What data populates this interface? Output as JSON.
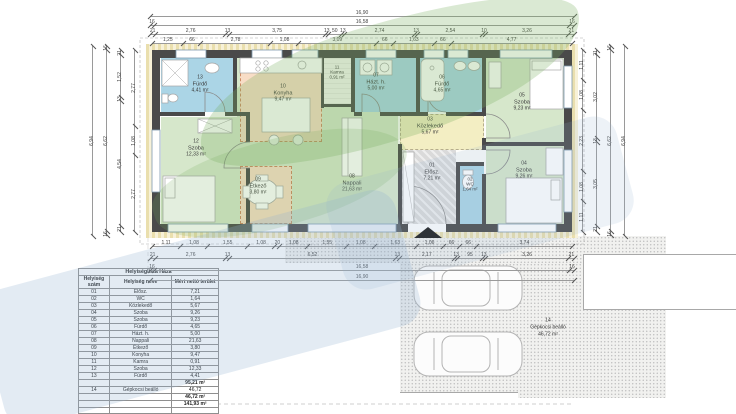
{
  "palette": {
    "green": "#d6e7cb",
    "blue": "#abd5e6",
    "peach": "#f8ddc6",
    "yellow": "#f3eec3",
    "gray": "#dadada",
    "insulation": "#eadfae",
    "stipple_bg": "#f1f1ef",
    "accent_dash": "#cd8a63",
    "wm_green": "rgba(118,172,92,0.27)",
    "wm_blue": "rgba(148,176,208,0.26)"
  },
  "plan": {
    "rooms": [
      {
        "num": "08",
        "name": "Nappali",
        "area": "21,63 m²",
        "x": 237,
        "y": 58,
        "w": 161,
        "h": 166,
        "fill": "green",
        "lx": 352,
        "ly": 183
      },
      {
        "num": "12",
        "name": "Szoba",
        "area": "12,33 m²",
        "x": 161,
        "y": 117,
        "w": 85,
        "h": 107,
        "fill": "green",
        "lx": 196,
        "ly": 148
      },
      {
        "num": "13",
        "name": "Fürdő",
        "area": "4,41 m²",
        "x": 161,
        "y": 58,
        "w": 72,
        "h": 54,
        "fill": "blue",
        "lx": 200,
        "ly": 84
      },
      {
        "num": "10",
        "name": "Konyha",
        "area": "9,47 m²",
        "x": 240,
        "y": 58,
        "w": 82,
        "h": 84,
        "fill": "peach",
        "dashed": true,
        "lx": 283,
        "ly": 93
      },
      {
        "num": "11",
        "name": "Kamra",
        "area": "0,91 m²",
        "x": 324,
        "y": 58,
        "w": 27,
        "h": 46,
        "fill": "white",
        "lx": 337,
        "ly": 72,
        "small": true
      },
      {
        "num": "07",
        "name": "Házt. h.",
        "area": "5,00 m²",
        "x": 355,
        "y": 58,
        "w": 61,
        "h": 54,
        "fill": "blue",
        "lx": 376,
        "ly": 82
      },
      {
        "num": "06",
        "name": "Fürdő",
        "area": "4,65 m²",
        "x": 420,
        "y": 58,
        "w": 62,
        "h": 54,
        "fill": "blue",
        "lx": 442,
        "ly": 84
      },
      {
        "num": "05",
        "name": "Szoba",
        "area": "9,23 m²",
        "x": 486,
        "y": 58,
        "w": 78,
        "h": 84,
        "fill": "green",
        "lx": 522,
        "ly": 102
      },
      {
        "num": "04",
        "name": "Szoba",
        "area": "9,26 m²",
        "x": 486,
        "y": 146,
        "w": 78,
        "h": 78,
        "fill": "green",
        "lx": 524,
        "ly": 170
      },
      {
        "num": "03",
        "name": "Közlekedő",
        "area": "5,67 m²",
        "x": 400,
        "y": 114,
        "w": 84,
        "h": 36,
        "fill": "yellow",
        "dashed2": true,
        "lx": 430,
        "ly": 126
      },
      {
        "num": "01",
        "name": "Elősz.",
        "area": "7,21 m²",
        "x": 402,
        "y": 150,
        "w": 54,
        "h": 74,
        "fill": "gray",
        "lx": 432,
        "ly": 172
      },
      {
        "num": "02",
        "name": "WC",
        "area": "1,64 m²",
        "x": 458,
        "y": 166,
        "w": 26,
        "h": 58,
        "fill": "blue",
        "lx": 470,
        "ly": 184,
        "small": true
      },
      {
        "num": "09",
        "name": "Étkező",
        "area": "3,80 m²",
        "x": 240,
        "y": 166,
        "w": 52,
        "h": 58,
        "fill": "peach",
        "dashed": true,
        "lx": 258,
        "ly": 186
      }
    ],
    "parking": {
      "num": "14",
      "name": "Gépkocsi beálló",
      "area": "46,72 m²"
    }
  },
  "dimensions": {
    "top": [
      {
        "x": 150,
        "y": 10,
        "len": 424,
        "segs": [
          {
            "t": "16,90",
            "f": 16.9
          }
        ]
      },
      {
        "x": 150,
        "y": 19,
        "len": 424,
        "segs": [
          {
            "t": "16",
            "f": 0.16
          },
          {
            "t": "16,58",
            "f": 16.58
          },
          {
            "t": "16",
            "f": 0.16
          }
        ]
      },
      {
        "x": 150,
        "y": 28,
        "len": 424,
        "segs": [
          {
            "t": "21",
            "f": 0.21
          },
          {
            "t": "2,76",
            "f": 2.76
          },
          {
            "t": "13",
            "f": 0.13
          },
          {
            "t": "3,75",
            "f": 3.75
          },
          {
            "t": "13",
            "f": 0.13
          },
          {
            "t": "50",
            "f": 0.5
          },
          {
            "t": "13",
            "f": 0.13
          },
          {
            "t": "2,74",
            "f": 2.74
          },
          {
            "t": "13",
            "f": 0.13
          },
          {
            "t": "2,54",
            "f": 2.54
          },
          {
            "t": "10",
            "f": 0.1
          },
          {
            "t": "3,26",
            "f": 3.26
          },
          {
            "t": "21",
            "f": 0.21
          }
        ]
      },
      {
        "x": 152,
        "y": 37,
        "len": 420,
        "segs": [
          {
            "t": "1,25",
            "f": 1.25
          },
          {
            "t": "66",
            "f": 0.66
          },
          {
            "t": "2,78",
            "f": 2.78
          },
          {
            "t": "1,08",
            "f": 1.08
          },
          {
            "t": "3,09",
            "f": 3.09
          },
          {
            "t": "66",
            "f": 0.66
          },
          {
            "t": "1,63",
            "f": 1.63
          },
          {
            "t": "66",
            "f": 0.66
          },
          {
            "t": "4,77",
            "f": 4.77
          }
        ]
      }
    ],
    "bottom": [
      {
        "x": 152,
        "y": 240,
        "len": 420,
        "segs": [
          {
            "t": "1,11",
            "f": 1.11
          },
          {
            "t": "1,08",
            "f": 1.08
          },
          {
            "t": "1,55",
            "f": 1.55
          },
          {
            "t": "1,08",
            "f": 1.08
          },
          {
            "t": "20",
            "f": 0.2
          },
          {
            "t": "1,08",
            "f": 1.08
          },
          {
            "t": "1,55",
            "f": 1.55
          },
          {
            "t": "1,08",
            "f": 1.08
          },
          {
            "t": "1,63",
            "f": 1.63
          },
          {
            "t": "1,06",
            "f": 1.06
          },
          {
            "t": "66",
            "f": 0.66
          },
          {
            "t": "66",
            "f": 0.66
          },
          {
            "t": "3,74",
            "f": 3.74
          }
        ]
      },
      {
        "x": 150,
        "y": 252,
        "len": 424,
        "segs": [
          {
            "t": "21",
            "f": 0.21
          },
          {
            "t": "2,76",
            "f": 2.76
          },
          {
            "t": "13",
            "f": 0.13
          },
          {
            "t": "6,52",
            "f": 6.52
          },
          {
            "t": "13",
            "f": 0.13
          },
          {
            "t": "2,17",
            "f": 2.17
          },
          {
            "t": "13",
            "f": 0.13
          },
          {
            "t": "95",
            "f": 0.95
          },
          {
            "t": "13",
            "f": 0.13
          },
          {
            "t": "3,26",
            "f": 3.26
          },
          {
            "t": "21",
            "f": 0.21
          }
        ]
      },
      {
        "x": 150,
        "y": 264,
        "len": 424,
        "segs": [
          {
            "t": "16",
            "f": 0.16
          },
          {
            "t": "16,58",
            "f": 16.58
          },
          {
            "t": "16",
            "f": 0.16
          }
        ]
      },
      {
        "x": 150,
        "y": 274,
        "len": 424,
        "segs": [
          {
            "t": "16,90",
            "f": 16.9
          }
        ]
      }
    ],
    "left": [
      {
        "x": 134,
        "y": 50,
        "len": 182,
        "segs": [
          {
            "t": "2,77",
            "f": 2.77
          },
          {
            "t": "1,08",
            "f": 1.08
          },
          {
            "t": "2,77",
            "f": 2.77
          }
        ]
      },
      {
        "x": 120,
        "y": 50,
        "len": 182,
        "segs": [
          {
            "t": "21",
            "f": 0.21
          },
          {
            "t": "1,52",
            "f": 1.52
          },
          {
            "t": "13",
            "f": 0.13
          },
          {
            "t": "4,54",
            "f": 4.54
          },
          {
            "t": "21",
            "f": 0.21
          }
        ]
      },
      {
        "x": 106,
        "y": 46,
        "len": 190,
        "segs": [
          {
            "t": "16",
            "f": 0.16
          },
          {
            "t": "6,62",
            "f": 6.62
          },
          {
            "t": "16",
            "f": 0.16
          }
        ]
      },
      {
        "x": 92,
        "y": 46,
        "len": 190,
        "segs": [
          {
            "t": "6,94",
            "f": 6.94
          }
        ]
      }
    ],
    "right": [
      {
        "x": 582,
        "y": 50,
        "len": 182,
        "segs": [
          {
            "t": "1,11",
            "f": 1.11
          },
          {
            "t": "1,08",
            "f": 1.08
          },
          {
            "t": "2,23",
            "f": 2.23
          },
          {
            "t": "1,08",
            "f": 1.08
          },
          {
            "t": "1,11",
            "f": 1.11
          }
        ]
      },
      {
        "x": 596,
        "y": 50,
        "len": 182,
        "segs": [
          {
            "t": "21",
            "f": 0.21
          },
          {
            "t": "3,02",
            "f": 3.02
          },
          {
            "t": "13",
            "f": 0.13
          },
          {
            "t": "3,05",
            "f": 3.05
          },
          {
            "t": "21",
            "f": 0.21
          }
        ]
      },
      {
        "x": 610,
        "y": 46,
        "len": 190,
        "segs": [
          {
            "t": "16",
            "f": 0.16
          },
          {
            "t": "6,62",
            "f": 6.62
          },
          {
            "t": "16",
            "f": 0.16
          }
        ]
      },
      {
        "x": 624,
        "y": 46,
        "len": 190,
        "segs": [
          {
            "t": "6,94",
            "f": 6.94
          }
        ]
      }
    ]
  },
  "table": {
    "title": "Helyiséglista Háza",
    "headers": [
      "Helyiség szám",
      "Helyiség neve",
      "Mért nettó terület"
    ],
    "rows": [
      {
        "c": [
          "01",
          "Elősz.",
          "7,21"
        ]
      },
      {
        "c": [
          "02",
          "WC",
          "1,64"
        ]
      },
      {
        "c": [
          "03",
          "Közlekedő",
          "5,67"
        ]
      },
      {
        "c": [
          "04",
          "Szoba",
          "9,26"
        ]
      },
      {
        "c": [
          "05",
          "Szoba",
          "9,23"
        ]
      },
      {
        "c": [
          "06",
          "Fürdő",
          "4,65"
        ]
      },
      {
        "c": [
          "07",
          "Házt. h.",
          "5,00"
        ]
      },
      {
        "c": [
          "08",
          "Nappali",
          "21,63"
        ]
      },
      {
        "c": [
          "09",
          "Étkező",
          "3,80"
        ]
      },
      {
        "c": [
          "10",
          "Konyha",
          "9,47"
        ]
      },
      {
        "c": [
          "11",
          "Kamra",
          "0,91"
        ]
      },
      {
        "c": [
          "12",
          "Szoba",
          "12,33"
        ]
      },
      {
        "c": [
          "13",
          "Fürdő",
          "4,41"
        ]
      },
      {
        "c": [
          "",
          "",
          "95,21 m²"
        ],
        "b": true
      },
      {
        "c": [
          "14",
          "Gépkocsi beálló",
          "46,72"
        ]
      },
      {
        "c": [
          "",
          "",
          "46,72 m²"
        ],
        "b": true
      },
      {
        "c": [
          "",
          "",
          "141,93 m²"
        ],
        "b": true
      },
      {
        "c": [
          "",
          "",
          ""
        ]
      },
      {
        "c": [
          "",
          "",
          ""
        ]
      }
    ]
  }
}
